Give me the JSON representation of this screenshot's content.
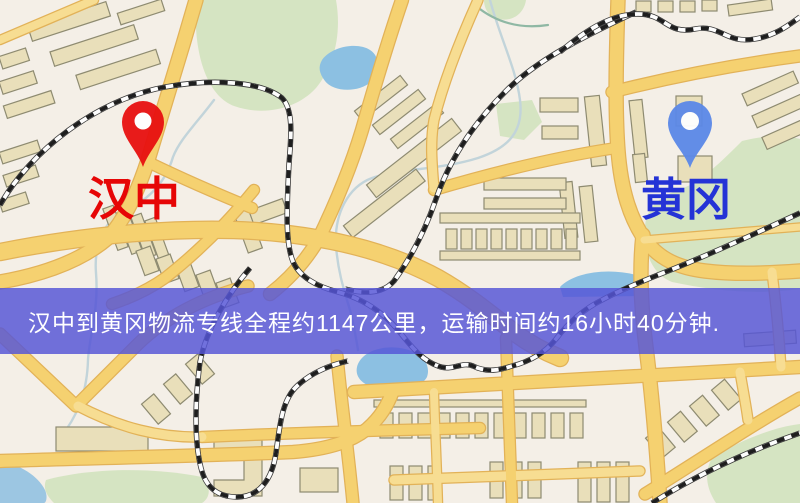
{
  "origin": {
    "label": "汉中",
    "pin_color": "#e81010",
    "label_color": "#e60606"
  },
  "destination": {
    "label": "黄冈",
    "pin_color": "#5b88e8",
    "label_color": "#2433d6"
  },
  "banner": {
    "text": "汉中到黄冈物流专线全程约1147公里，运输时间约16小时40分钟.",
    "background": "#5656d6",
    "text_color": "#ffffff"
  },
  "map_palette": {
    "background": "#f4efe7",
    "road_fill": "#f5d170",
    "road_edge": "#e2b258",
    "building_fill": "#e9dfba",
    "building_outline": "#8e8b71",
    "park_green": "#d5e4c2",
    "water_blue": "#8cc0e2",
    "railway_dark": "#1e1e1e"
  }
}
